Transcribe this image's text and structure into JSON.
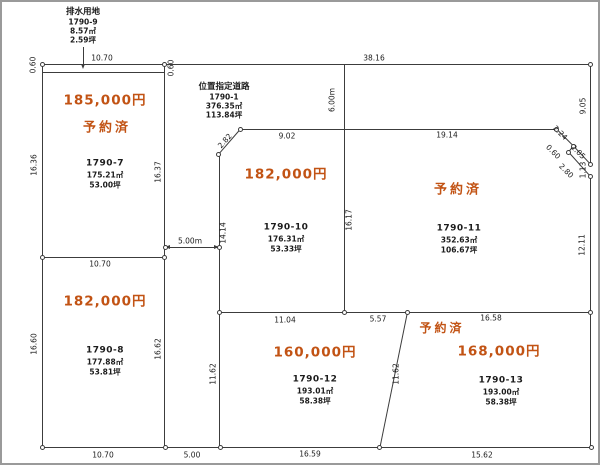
{
  "colors": {
    "price": "#c25314",
    "line": "#3c3c3c",
    "text": "#1c1c1c",
    "frame": "#9a9a9a"
  },
  "drainage": {
    "title": "排水用地",
    "id": "1790-9",
    "area": "8.57㎡",
    "tsubo": "2.59坪"
  },
  "road": {
    "title": "位置指定道路",
    "id": "1790-1",
    "area": "376.35㎡",
    "tsubo": "113.84坪"
  },
  "lots": {
    "lot7": {
      "id": "1790-7",
      "price": "185,000円",
      "status": "予約済",
      "area": "175.21㎡",
      "tsubo": "53.00坪"
    },
    "lot8": {
      "id": "1790-8",
      "price": "182,000円",
      "area": "177.88㎡",
      "tsubo": "53.81坪"
    },
    "lot10": {
      "id": "1790-10",
      "price": "182,000円",
      "area": "176.31㎡",
      "tsubo": "53.33坪"
    },
    "lot11": {
      "id": "1790-11",
      "status": "予約済",
      "area": "352.63㎡",
      "tsubo": "106.67坪"
    },
    "lot12": {
      "id": "1790-12",
      "price": "160,000円",
      "area": "193.01㎡",
      "tsubo": "58.38坪"
    },
    "lot13": {
      "id": "1790-13",
      "price": "168,000円",
      "status": "予約済",
      "area": "193.00㎡",
      "tsubo": "58.38坪"
    }
  },
  "dims": {
    "strip_width": "10.70",
    "strip_thickness_left": "0.60",
    "strip_thickness_right": "0.60",
    "road_top": "38.16",
    "road_width": "6.00m",
    "left_upper": "16.36",
    "left_lower": "16.60",
    "lot7_east": "16.37",
    "lot8_top": "10.70",
    "lot8_east": "16.62",
    "road_strip_width": "5.00m",
    "lot10_top": "9.02",
    "lot10_cut": "2.82",
    "lot10_west": "14.14",
    "lot10_east": "16.17",
    "lot11_top": "19.14",
    "ne_cut_a": "2.24",
    "ne_cut_b": "2.05",
    "ne_cut_c": "0.60",
    "ne_cut_d": "2.80",
    "right_upper": "9.05",
    "right_mid": "1.13",
    "right_lower": "12.11",
    "mid_seg1": "11.04",
    "mid_seg2": "5.57",
    "mid_seg3": "16.58",
    "lot12_west": "11.62",
    "lot12_east": "11.62",
    "bottom1": "10.70",
    "bottom2": "5.00",
    "bottom3": "16.59",
    "bottom4": "15.62"
  }
}
